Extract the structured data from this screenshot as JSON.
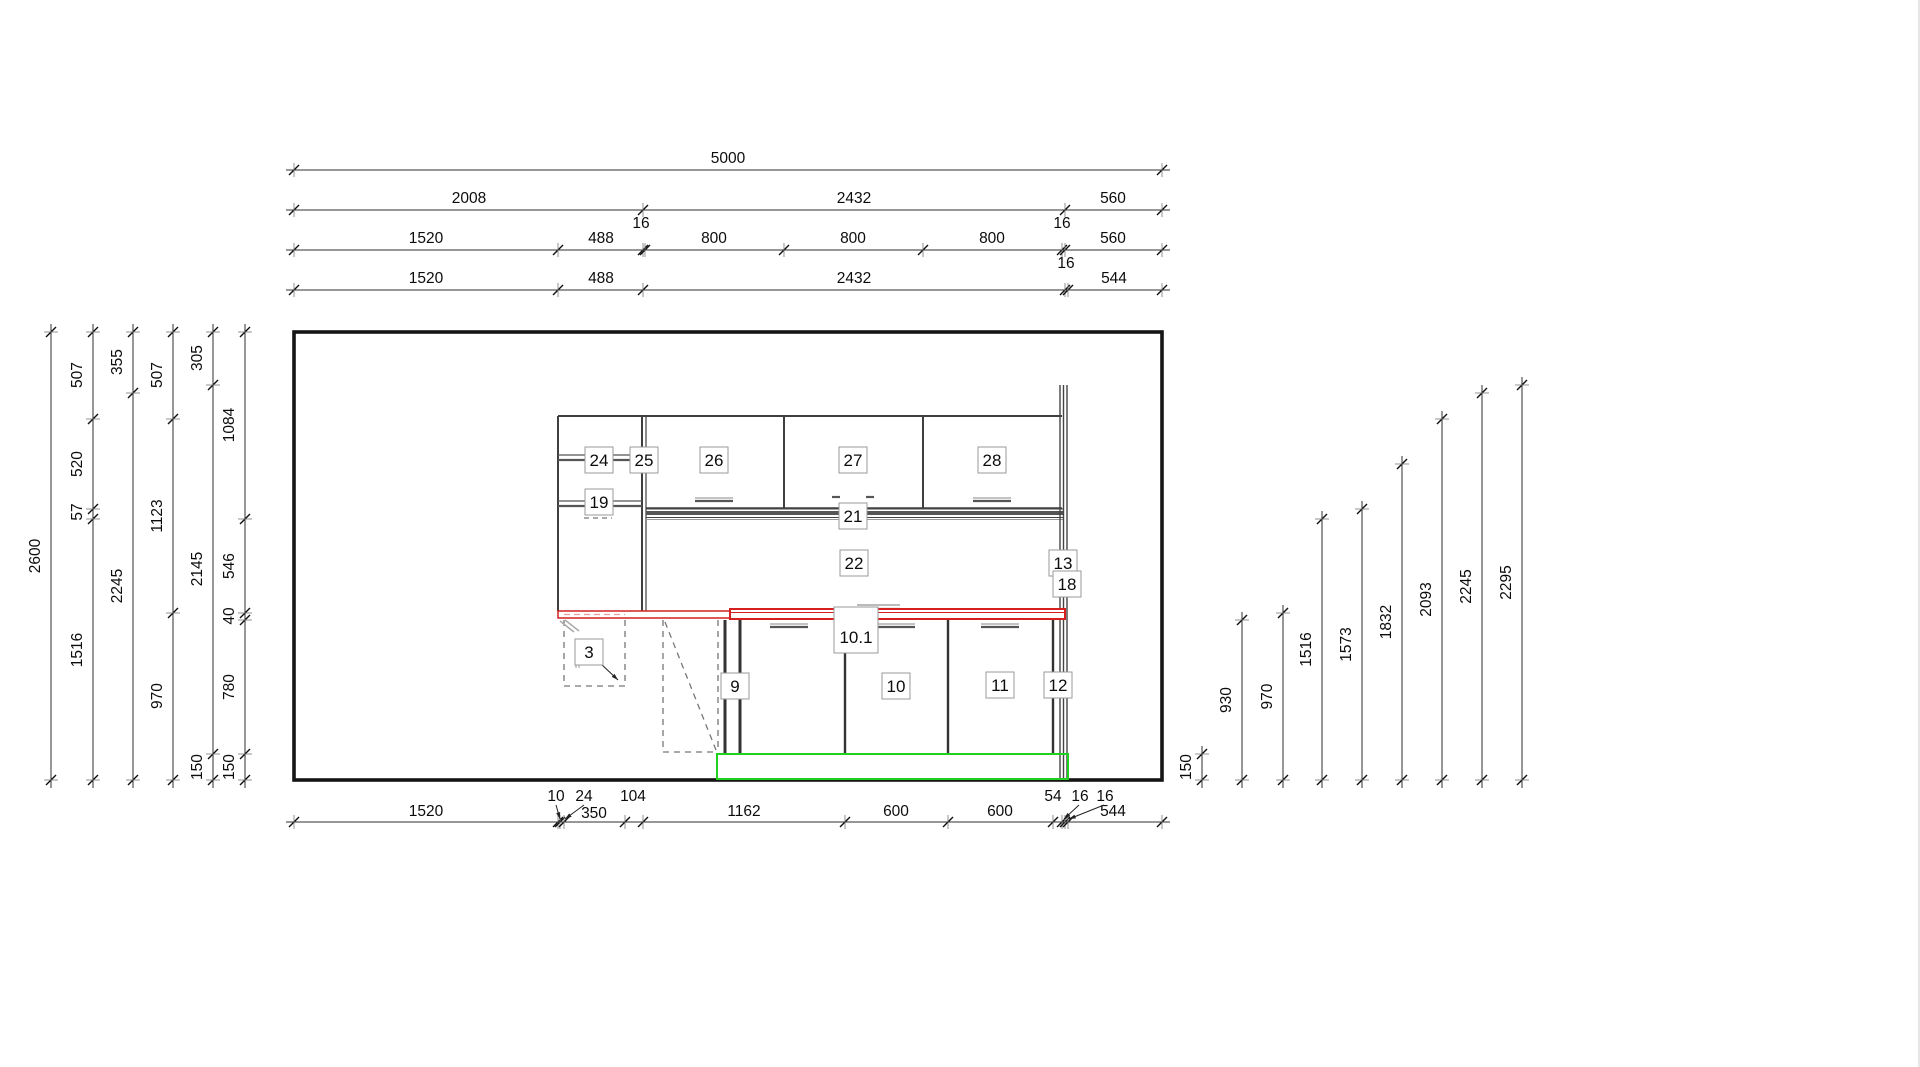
{
  "drawing_type": "kitchen-elevation-cad",
  "colors": {
    "dim_line": "#2f2f2f",
    "tick": "#111111",
    "cabinet_line": "#3f3f3f",
    "light_line": "#888888",
    "dashed_line": "#777777",
    "room_outline": "#151515",
    "counter_red": "#d42020",
    "counter_red_light": "#ea9a9a",
    "plinth_green": "#1fd11f",
    "band_fill": "#555555",
    "label_box_border": "#9a9a9a",
    "label_box_fill": "#ffffff",
    "text": "#0c0c0c"
  },
  "room": {
    "x1": 294,
    "y1": 332,
    "x2": 1162,
    "y2": 780
  },
  "top_dimension_rows": [
    {
      "y": 170,
      "ticks": [
        294,
        1162
      ],
      "labels": [
        {
          "t": "5000",
          "x": 728,
          "y": 163
        }
      ]
    },
    {
      "y": 210,
      "ticks": [
        294,
        643,
        1065,
        1162
      ],
      "labels": [
        {
          "t": "2008",
          "x": 469,
          "y": 203
        },
        {
          "t": "2432",
          "x": 854,
          "y": 203
        },
        {
          "t": "560",
          "x": 1113,
          "y": 203
        }
      ]
    },
    {
      "y": 250,
      "ticks": [
        294,
        558,
        643,
        645,
        784,
        923,
        1062,
        1065,
        1162
      ],
      "labels": [
        {
          "t": "1520",
          "x": 426,
          "y": 243
        },
        {
          "t": "488",
          "x": 601,
          "y": 243
        },
        {
          "t": "16",
          "x": 641,
          "y": 228
        },
        {
          "t": "800",
          "x": 714,
          "y": 243
        },
        {
          "t": "800",
          "x": 853,
          "y": 243
        },
        {
          "t": "800",
          "x": 992,
          "y": 243
        },
        {
          "t": "16",
          "x": 1062,
          "y": 228
        },
        {
          "t": "560",
          "x": 1113,
          "y": 243
        }
      ]
    },
    {
      "y": 290,
      "ticks": [
        294,
        558,
        643,
        1065,
        1068,
        1162
      ],
      "labels": [
        {
          "t": "1520",
          "x": 426,
          "y": 283
        },
        {
          "t": "488",
          "x": 601,
          "y": 283
        },
        {
          "t": "2432",
          "x": 854,
          "y": 283
        },
        {
          "t": "16",
          "x": 1066,
          "y": 268
        },
        {
          "t": "544",
          "x": 1114,
          "y": 283
        }
      ]
    }
  ],
  "bottom_dimension_row": {
    "y": 822,
    "ticks": [
      294,
      558,
      560,
      564,
      625,
      643,
      845,
      948,
      1053,
      1062,
      1065,
      1068,
      1162
    ],
    "labels": [
      {
        "t": "1520",
        "x": 426,
        "y": 816
      },
      {
        "t": "10",
        "x": 556,
        "y": 801
      },
      {
        "t": "24",
        "x": 584,
        "y": 801
      },
      {
        "t": "350",
        "x": 594,
        "y": 818
      },
      {
        "t": "104",
        "x": 633,
        "y": 801
      },
      {
        "t": "1162",
        "x": 744,
        "y": 816
      },
      {
        "t": "600",
        "x": 896,
        "y": 816
      },
      {
        "t": "600",
        "x": 1000,
        "y": 816
      },
      {
        "t": "54",
        "x": 1053,
        "y": 801
      },
      {
        "t": "16",
        "x": 1080,
        "y": 801
      },
      {
        "t": "16",
        "x": 1105,
        "y": 801
      },
      {
        "t": "544",
        "x": 1113,
        "y": 816
      }
    ],
    "leaders": [
      [
        556,
        805,
        560,
        819
      ],
      [
        584,
        805,
        565,
        819
      ],
      [
        1079,
        805,
        1064,
        819
      ],
      [
        1104,
        805,
        1069,
        819
      ]
    ]
  },
  "left_dimension_cols": [
    {
      "x": 51,
      "ticks": [
        332,
        780
      ],
      "labels": [
        {
          "t": "2600",
          "y": 556
        }
      ]
    },
    {
      "x": 93,
      "ticks": [
        332,
        419,
        509,
        519,
        780
      ],
      "labels": [
        {
          "t": "507",
          "y": 375
        },
        {
          "t": "520",
          "y": 464
        },
        {
          "t": "57",
          "y": 512
        },
        {
          "t": "1516",
          "y": 650
        }
      ]
    },
    {
      "x": 133,
      "ticks": [
        332,
        393,
        780
      ],
      "labels": [
        {
          "t": "355",
          "y": 362
        },
        {
          "t": "2245",
          "y": 586
        }
      ]
    },
    {
      "x": 173,
      "ticks": [
        332,
        419,
        613,
        780
      ],
      "labels": [
        {
          "t": "507",
          "y": 375
        },
        {
          "t": "1123",
          "y": 516
        },
        {
          "t": "970",
          "y": 696
        }
      ]
    },
    {
      "x": 213,
      "ticks": [
        332,
        385,
        754,
        780
      ],
      "labels": [
        {
          "t": "305",
          "y": 358
        },
        {
          "t": "2145",
          "y": 569
        },
        {
          "t": "150",
          "y": 767
        }
      ]
    },
    {
      "x": 245,
      "ticks": [
        332,
        519,
        613,
        620,
        754,
        780
      ],
      "labels": [
        {
          "t": "1084",
          "y": 425
        },
        {
          "t": "546",
          "y": 566
        },
        {
          "t": "40",
          "y": 616
        },
        {
          "t": "780",
          "y": 687
        },
        {
          "t": "150",
          "y": 767
        }
      ]
    }
  ],
  "right_dimension_cols": [
    {
      "x": 1202,
      "top": 754,
      "label": "150"
    },
    {
      "x": 1242,
      "top": 620,
      "label": "930"
    },
    {
      "x": 1283,
      "top": 613,
      "label": "970"
    },
    {
      "x": 1322,
      "top": 519,
      "label": "1516"
    },
    {
      "x": 1362,
      "top": 509,
      "label": "1573"
    },
    {
      "x": 1402,
      "top": 464,
      "label": "1832"
    },
    {
      "x": 1442,
      "top": 419,
      "label": "2093"
    },
    {
      "x": 1482,
      "top": 393,
      "label": "2245"
    },
    {
      "x": 1522,
      "top": 385,
      "label": "2295"
    }
  ],
  "item_labels": [
    {
      "t": "24",
      "x": 599,
      "y": 460
    },
    {
      "t": "25",
      "x": 644,
      "y": 460
    },
    {
      "t": "26",
      "x": 714,
      "y": 460
    },
    {
      "t": "27",
      "x": 853,
      "y": 460
    },
    {
      "t": "28",
      "x": 992,
      "y": 460
    },
    {
      "t": "19",
      "x": 599,
      "y": 502
    },
    {
      "t": "21",
      "x": 853,
      "y": 516
    },
    {
      "t": "22",
      "x": 854,
      "y": 563
    },
    {
      "t": "13",
      "x": 1063,
      "y": 563
    },
    {
      "t": "18",
      "x": 1067,
      "y": 584
    },
    {
      "t": "10.1",
      "x": 856,
      "y": 630,
      "w": 44,
      "h": 46,
      "ty": 637
    },
    {
      "t": "3",
      "x": 589,
      "y": 652
    },
    {
      "t": "9",
      "x": 735,
      "y": 686
    },
    {
      "t": "10",
      "x": 896,
      "y": 686
    },
    {
      "t": "11",
      "x": 1000,
      "y": 685
    },
    {
      "t": "12",
      "x": 1058,
      "y": 685
    }
  ],
  "item_leaders": [
    [
      600,
      663,
      618,
      680
    ]
  ]
}
